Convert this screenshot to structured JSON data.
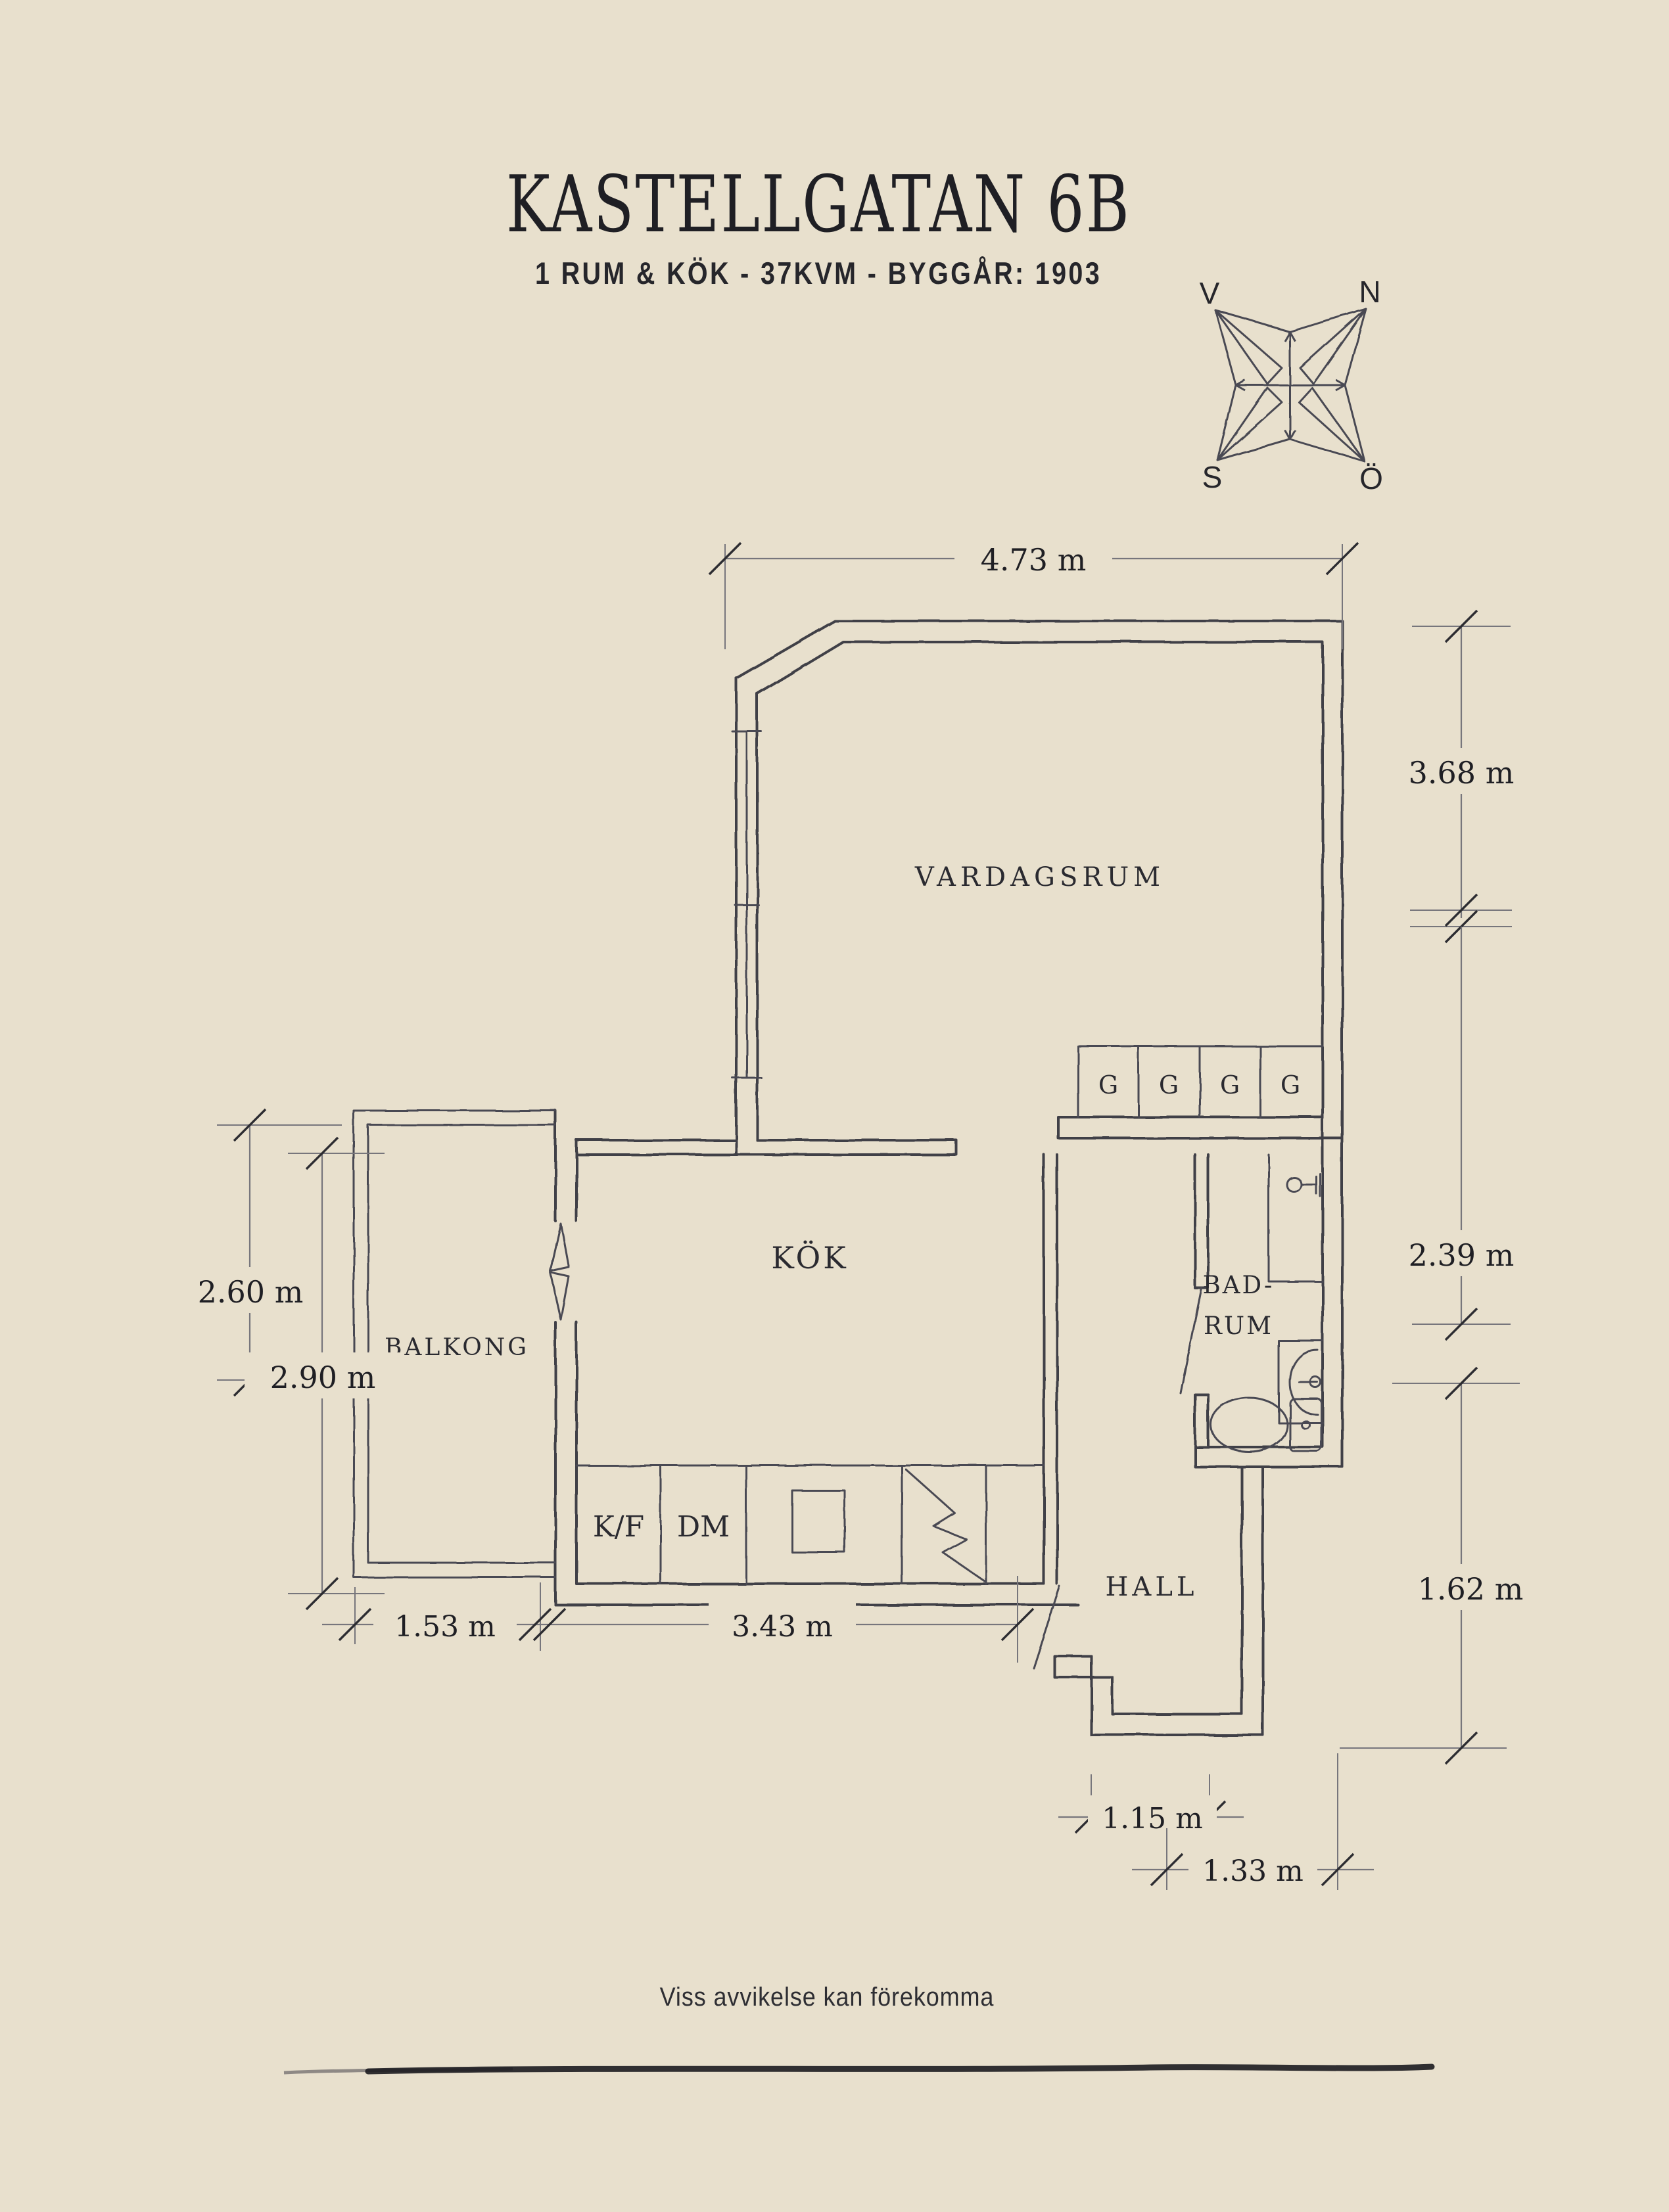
{
  "page": {
    "background_color": "#e8e0cd",
    "wall_ink_color": "#403f46",
    "text_color": "#1f1f24"
  },
  "header": {
    "title": "KASTELLGATAN 6B",
    "subtitle": "1 RUM & KÖK  -  37KVM  -  BYGGÅR: 1903"
  },
  "compass": {
    "west": "V",
    "north": "N",
    "south": "S",
    "east": "Ö"
  },
  "rooms": {
    "living_room": "VARDAGSRUM",
    "kitchen": "KÖK",
    "balcony": "BALKONG",
    "bathroom_line1": "BAD-",
    "bathroom_line2": "RUM",
    "hall": "HALL"
  },
  "fixtures": {
    "fridge_freezer": "K/F",
    "dishwasher": "DM",
    "closets": [
      "G",
      "G",
      "G",
      "G"
    ]
  },
  "dimensions": {
    "top_width": "4.73 m",
    "right_upper": "3.68 m",
    "right_middle": "2.39 m",
    "right_lower": "1.62 m",
    "left_outer": "2.60 m",
    "left_inner": "2.90 m",
    "bottom_balcony": "1.53 m",
    "bottom_kitchen": "3.43 m",
    "bottom_hall_inner": "1.15 m",
    "bottom_hall_outer": "1.33 m"
  },
  "footer": {
    "disclaimer": "Viss avvikelse kan förekomma"
  }
}
